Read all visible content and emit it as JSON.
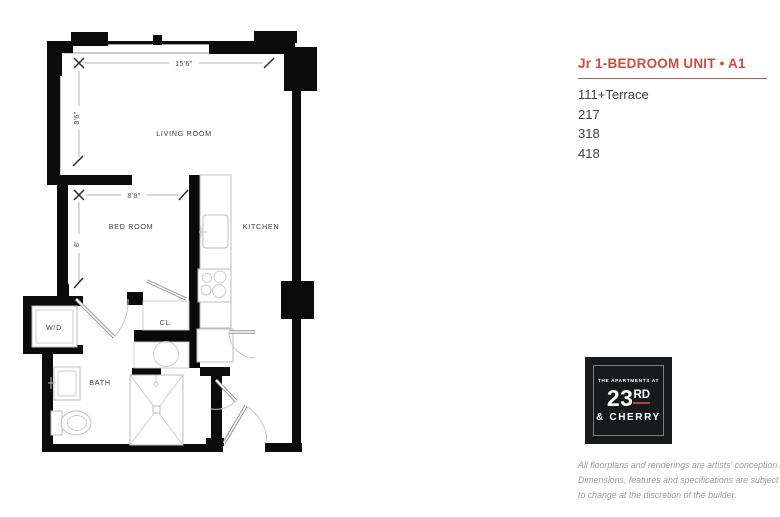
{
  "panel": {
    "title": "Jr 1-BEDROOM UNIT • A1",
    "accent_color": "#CE4B3E",
    "units": [
      "111+Terrace",
      "217",
      "318",
      "418"
    ]
  },
  "logo": {
    "line1": "THE APARTMENTS AT",
    "number": "23",
    "number_suffix": "RD",
    "line3": "& CHERRY",
    "underline_color": "#b8442f"
  },
  "disclaimer": {
    "line1": "All floorplans and renderings are artists' conception.",
    "line2": "Dimensions, features and specifications are subject",
    "line3": "to change at the discretion of the builder."
  },
  "floorplan": {
    "rooms": {
      "living": "LIVING ROOM",
      "bed": "BED ROOM",
      "kitchen": "KITCHEN",
      "bath": "BATH",
      "closet": "CL",
      "laundry": "W/D"
    },
    "dimensions": {
      "living_width": "15'6\"",
      "living_depth": "8'6\"",
      "bed_width": "8'8\"",
      "bed_depth": "8'"
    }
  }
}
